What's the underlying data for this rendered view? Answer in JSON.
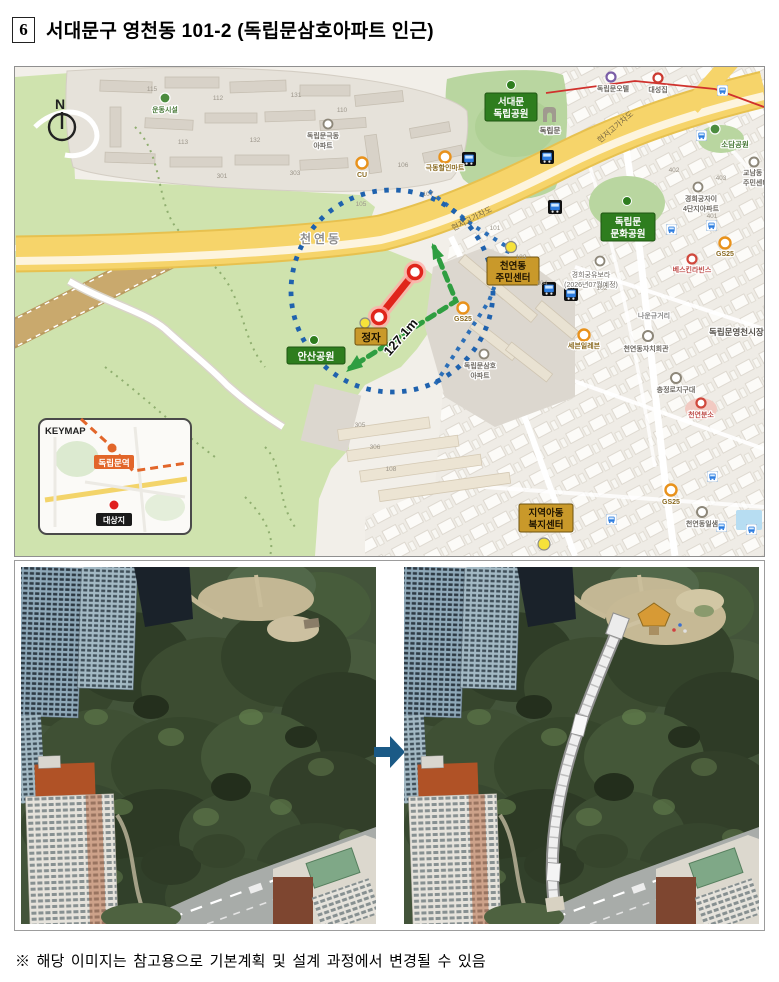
{
  "page": {
    "title_number": "6",
    "title": "서대문구 영천동 101-2 (독립문삼호아파트 인근)",
    "footnote": "※ 해당 이미지는 참고용으로 기본계획 및 설계 과정에서 변경될 수 있음"
  },
  "map": {
    "compass_n": "N",
    "area_label": "천연동",
    "road_overpass": "현저고가차도",
    "distance": "127.1m",
    "parks": {
      "seodaemun_l1": "서대문",
      "seodaemun_l2": "독립공원",
      "gate": "독립문",
      "munhwa_l1": "독립문",
      "munhwa_l2": "문화공원",
      "ansan": "안산공원",
      "sodam": "소담공원"
    },
    "sites": {
      "jeongja": "정자",
      "jumin_l1": "천연동",
      "jumin_l2": "주민센터",
      "bokji_l1": "지역아동",
      "bokji_l2": "복지센터"
    },
    "apts": {
      "geukdong_l1": "독립문극동",
      "geukdong_l2": "아파트",
      "samho_l1": "독립문삼호",
      "samho_l2": "아파트",
      "jai_l1": "경희궁자이",
      "jai_l2": "4단지아파트",
      "ubora_l1": "경희궁유보라",
      "ubora_l2": "(2026년07월예정)"
    },
    "pois": {
      "cu": "CU",
      "gs25": "GS25",
      "seven": "세븐일레븐",
      "mart": "극동할인마트",
      "sports": "운동시설",
      "officetel": "독립문오텔",
      "daeseong": "대성집",
      "baskin": "베스킨라빈스",
      "jachi": "천연동자치회관",
      "jigudae": "충정로지구대",
      "bunso": "천연분소",
      "naun": "나운규거리",
      "yeongcheon": "독립문영천시장",
      "gyonam_l1": "교남동",
      "gyonam_l2": "주민센터",
      "ilsaem": "천연동일샘"
    },
    "numbers": [
      "115",
      "112",
      "131",
      "110",
      "113",
      "132",
      "301",
      "303",
      "106",
      "107",
      "105",
      "101",
      "103",
      "104",
      "102",
      "305",
      "306",
      "108",
      "402",
      "403",
      "401"
    ],
    "keymap": {
      "title": "KEYMAP",
      "station": "독립문역",
      "site": "대상지"
    },
    "colors": {
      "circle_blue": "#1f62ae",
      "route_red": "#e0251b",
      "path_green": "#2f9e41",
      "road_yellow": "#f6d46a",
      "park_green": "#cfe3ae",
      "label_green": "#2e7d1e",
      "label_yellow": "#c9992a",
      "keymap_orange": "#e2662a",
      "arrow_blue": "#1b5a86"
    }
  }
}
